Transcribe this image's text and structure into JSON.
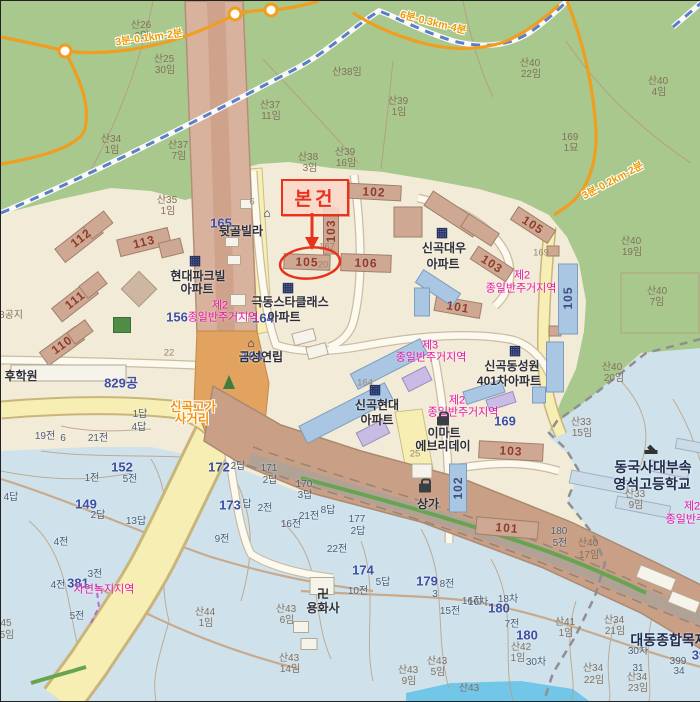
{
  "palette": {
    "urban": "#f2ebd8",
    "forest": "#a8c88e",
    "fields": "#cfe2ec",
    "water": "#72c6e8",
    "road_tan": "#d8b29c",
    "band": "#c99f86",
    "road_yellow": "#f7eeb4",
    "road_yellow_edge": "#c9b57c",
    "trail_orange": "#f09e20",
    "railway_blue": "#5b7ec8",
    "accent_red": "#e8321c",
    "zone_magenta": "#ea12a8",
    "parcel_blue": "#3d4fa4",
    "building_tan": "#cfa893",
    "building_blue": "#a9c6e2",
    "building_lav": "#c9bce4",
    "building_white": "#f6f3ea",
    "building_sky": "#ccdbe8"
  },
  "callout": {
    "label": "본건",
    "target_building": "105"
  },
  "map": {
    "labels": [
      {
        "t": "산26",
        "x": 140,
        "y": 25,
        "c": "mtn"
      },
      {
        "t": "3임",
        "x": 141,
        "y": 36,
        "c": "mtn"
      },
      {
        "t": "산25",
        "x": 163,
        "y": 59,
        "c": "mtn"
      },
      {
        "t": "30임",
        "x": 164,
        "y": 70,
        "c": "mtn"
      },
      {
        "t": "산34",
        "x": 110,
        "y": 139,
        "c": "mtn"
      },
      {
        "t": "1임",
        "x": 111,
        "y": 150,
        "c": "mtn"
      },
      {
        "t": "산37",
        "x": 269,
        "y": 105,
        "c": "mtn"
      },
      {
        "t": "11임",
        "x": 270,
        "y": 116,
        "c": "mtn"
      },
      {
        "t": "산37",
        "x": 177,
        "y": 145,
        "c": "mtn"
      },
      {
        "t": "7임",
        "x": 178,
        "y": 156,
        "c": "mtn"
      },
      {
        "t": "산38",
        "x": 307,
        "y": 157,
        "c": "mtn"
      },
      {
        "t": "3임",
        "x": 309,
        "y": 168,
        "c": "mtn"
      },
      {
        "t": "산39",
        "x": 344,
        "y": 152,
        "c": "mtn"
      },
      {
        "t": "16임",
        "x": 345,
        "y": 163,
        "c": "mtn"
      },
      {
        "t": "산38임",
        "x": 346,
        "y": 72,
        "c": "mtn"
      },
      {
        "t": "산39",
        "x": 397,
        "y": 101,
        "c": "mtn"
      },
      {
        "t": "1임",
        "x": 398,
        "y": 112,
        "c": "mtn"
      },
      {
        "t": "산40",
        "x": 529,
        "y": 63,
        "c": "mtn"
      },
      {
        "t": "22임",
        "x": 530,
        "y": 74,
        "c": "mtn"
      },
      {
        "t": "산40",
        "x": 657,
        "y": 81,
        "c": "mtn"
      },
      {
        "t": "4임",
        "x": 658,
        "y": 92,
        "c": "mtn"
      },
      {
        "t": "169",
        "x": 569,
        "y": 137,
        "c": "mtn"
      },
      {
        "t": "1묘",
        "x": 570,
        "y": 148,
        "c": "mtn"
      },
      {
        "t": "산35",
        "x": 166,
        "y": 200,
        "c": "mtn"
      },
      {
        "t": "1임",
        "x": 167,
        "y": 211,
        "c": "mtn"
      },
      {
        "t": "산40",
        "x": 630,
        "y": 241,
        "c": "mtn"
      },
      {
        "t": "19임",
        "x": 631,
        "y": 252,
        "c": "mtn"
      },
      {
        "t": "산40",
        "x": 656,
        "y": 291,
        "c": "mtn"
      },
      {
        "t": "7임",
        "x": 656,
        "y": 302,
        "c": "mtn"
      },
      {
        "t": "산40",
        "x": 611,
        "y": 367,
        "c": "mtn"
      },
      {
        "t": "20임",
        "x": 613,
        "y": 378,
        "c": "mtn"
      },
      {
        "t": "산33",
        "x": 580,
        "y": 422,
        "c": "mtn"
      },
      {
        "t": "15임",
        "x": 581,
        "y": 433,
        "c": "mtn"
      },
      {
        "t": "산33",
        "x": 634,
        "y": 494,
        "c": "mtn"
      },
      {
        "t": "9임",
        "x": 635,
        "y": 505,
        "c": "mtn"
      },
      {
        "t": "산44",
        "x": 204,
        "y": 612,
        "c": "mtn"
      },
      {
        "t": "1임",
        "x": 205,
        "y": 623,
        "c": "mtn"
      },
      {
        "t": "45",
        "x": 5,
        "y": 623,
        "c": "mtn"
      },
      {
        "t": "5임",
        "x": 6,
        "y": 635,
        "c": "mtn"
      },
      {
        "t": "산43",
        "x": 285,
        "y": 609,
        "c": "mtn"
      },
      {
        "t": "6임",
        "x": 286,
        "y": 620,
        "c": "mtn"
      },
      {
        "t": "산43",
        "x": 288,
        "y": 658,
        "c": "mtn"
      },
      {
        "t": "14임",
        "x": 289,
        "y": 669,
        "c": "mtn"
      },
      {
        "t": "산43",
        "x": 407,
        "y": 670,
        "c": "mtn"
      },
      {
        "t": "9임",
        "x": 408,
        "y": 681,
        "c": "mtn"
      },
      {
        "t": "산43",
        "x": 436,
        "y": 661,
        "c": "mtn"
      },
      {
        "t": "5임",
        "x": 437,
        "y": 672,
        "c": "mtn"
      },
      {
        "t": "산43",
        "x": 468,
        "y": 688,
        "c": "mtn"
      },
      {
        "t": "산41",
        "x": 564,
        "y": 622,
        "c": "mtn"
      },
      {
        "t": "1임",
        "x": 565,
        "y": 633,
        "c": "mtn"
      },
      {
        "t": "산34",
        "x": 613,
        "y": 620,
        "c": "mtn"
      },
      {
        "t": "21임",
        "x": 614,
        "y": 631,
        "c": "mtn"
      },
      {
        "t": "산34",
        "x": 592,
        "y": 668,
        "c": "mtn"
      },
      {
        "t": "22임",
        "x": 593,
        "y": 680,
        "c": "mtn"
      },
      {
        "t": "산34",
        "x": 636,
        "y": 677,
        "c": "mtn"
      },
      {
        "t": "23임",
        "x": 637,
        "y": 688,
        "c": "mtn"
      },
      {
        "t": "산40",
        "x": 587,
        "y": 543,
        "c": "mtn"
      },
      {
        "t": "17임",
        "x": 588,
        "y": 555,
        "c": "mtn"
      },
      {
        "t": "산42",
        "x": 520,
        "y": 647,
        "c": "mtn"
      },
      {
        "t": "1임",
        "x": 517,
        "y": 658,
        "c": "mtn"
      },
      {
        "t": "8공지",
        "x": 10,
        "y": 315,
        "c": "mtn"
      },
      {
        "t": "1전",
        "x": 91,
        "y": 478,
        "c": "fld"
      },
      {
        "t": "5전",
        "x": 129,
        "y": 479,
        "c": "fld"
      },
      {
        "t": "4답",
        "x": 10,
        "y": 497,
        "c": "fld"
      },
      {
        "t": "2답",
        "x": 97,
        "y": 515,
        "c": "fld"
      },
      {
        "t": "13답",
        "x": 135,
        "y": 521,
        "c": "fld"
      },
      {
        "t": "4전",
        "x": 60,
        "y": 542,
        "c": "fld"
      },
      {
        "t": "4전",
        "x": 57,
        "y": 585,
        "c": "fld"
      },
      {
        "t": "3전",
        "x": 94,
        "y": 574,
        "c": "fld"
      },
      {
        "t": "5전",
        "x": 76,
        "y": 616,
        "c": "fld"
      },
      {
        "t": "9전",
        "x": 221,
        "y": 539,
        "c": "fld"
      },
      {
        "t": "2전",
        "x": 264,
        "y": 508,
        "c": "fld"
      },
      {
        "t": "16전",
        "x": 290,
        "y": 524,
        "c": "fld"
      },
      {
        "t": "21전",
        "x": 308,
        "y": 516,
        "c": "fld"
      },
      {
        "t": "8답",
        "x": 327,
        "y": 510,
        "c": "fld"
      },
      {
        "t": "177",
        "x": 356,
        "y": 519,
        "c": "fld"
      },
      {
        "t": "2답",
        "x": 357,
        "y": 531,
        "c": "fld"
      },
      {
        "t": "22전",
        "x": 336,
        "y": 549,
        "c": "fld"
      },
      {
        "t": "5답",
        "x": 382,
        "y": 582,
        "c": "fld"
      },
      {
        "t": "10전",
        "x": 357,
        "y": 591,
        "c": "fld"
      },
      {
        "t": "8전",
        "x": 446,
        "y": 584,
        "c": "fld"
      },
      {
        "t": "3",
        "x": 434,
        "y": 594,
        "c": "fld"
      },
      {
        "t": "16전",
        "x": 471,
        "y": 601,
        "c": "fld"
      },
      {
        "t": "15전",
        "x": 449,
        "y": 611,
        "c": "fld"
      },
      {
        "t": "171",
        "x": 268,
        "y": 468,
        "c": "fld"
      },
      {
        "t": "2답",
        "x": 269,
        "y": 480,
        "c": "fld"
      },
      {
        "t": "170",
        "x": 303,
        "y": 484,
        "c": "fld"
      },
      {
        "t": "3답",
        "x": 304,
        "y": 495,
        "c": "fld"
      },
      {
        "t": "19전",
        "x": 44,
        "y": 436,
        "c": "fld"
      },
      {
        "t": "6",
        "x": 62,
        "y": 438,
        "c": "fld"
      },
      {
        "t": "21전",
        "x": 97,
        "y": 438,
        "c": "fld"
      },
      {
        "t": "1답",
        "x": 139,
        "y": 414,
        "c": "fld"
      },
      {
        "t": "4답",
        "x": 138,
        "y": 427,
        "c": "fld"
      },
      {
        "t": "2답",
        "x": 237,
        "y": 466,
        "c": "fld"
      },
      {
        "t": "답",
        "x": 246,
        "y": 504,
        "c": "fld"
      },
      {
        "t": "180",
        "x": 558,
        "y": 531,
        "c": "fld"
      },
      {
        "t": "5전",
        "x": 559,
        "y": 543,
        "c": "fld"
      },
      {
        "t": "7전",
        "x": 511,
        "y": 624,
        "c": "fld"
      },
      {
        "t": "16차",
        "x": 477,
        "y": 602,
        "c": "fld"
      },
      {
        "t": "18차",
        "x": 507,
        "y": 599,
        "c": "fld"
      },
      {
        "t": "30차",
        "x": 535,
        "y": 662,
        "c": "fld"
      },
      {
        "t": "30차",
        "x": 637,
        "y": 651,
        "c": "fld"
      },
      {
        "t": "31",
        "x": 637,
        "y": 668,
        "c": "fld"
      },
      {
        "t": "399",
        "x": 677,
        "y": 661,
        "c": "fld"
      },
      {
        "t": "34",
        "x": 678,
        "y": 671,
        "c": "fld"
      },
      {
        "t": "22",
        "x": 168,
        "y": 352,
        "c": "g"
      },
      {
        "t": "6",
        "x": 251,
        "y": 201,
        "c": "g"
      },
      {
        "t": "167",
        "x": 326,
        "y": 246,
        "c": "g"
      },
      {
        "t": "20",
        "x": 322,
        "y": 264,
        "c": "g"
      },
      {
        "t": "169",
        "x": 540,
        "y": 252,
        "c": "g"
      },
      {
        "t": "25",
        "x": 414,
        "y": 453,
        "c": "g"
      },
      {
        "t": "164",
        "x": 364,
        "y": 382,
        "c": "g"
      },
      {
        "t": "156",
        "x": 176,
        "y": 316,
        "c": "num"
      },
      {
        "t": "164",
        "x": 262,
        "y": 317,
        "c": "num"
      },
      {
        "t": "165",
        "x": 220,
        "y": 222,
        "c": "num"
      },
      {
        "t": "164",
        "x": 251,
        "y": 355,
        "c": "num"
      },
      {
        "t": "152",
        "x": 121,
        "y": 466,
        "c": "num"
      },
      {
        "t": "149",
        "x": 85,
        "y": 503,
        "c": "num"
      },
      {
        "t": "381",
        "x": 77,
        "y": 582,
        "c": "num"
      },
      {
        "t": "174",
        "x": 362,
        "y": 569,
        "c": "num"
      },
      {
        "t": "179",
        "x": 426,
        "y": 580,
        "c": "num"
      },
      {
        "t": "172",
        "x": 218,
        "y": 466,
        "c": "num"
      },
      {
        "t": "173",
        "x": 229,
        "y": 504,
        "c": "num"
      },
      {
        "t": "180",
        "x": 498,
        "y": 607,
        "c": "num"
      },
      {
        "t": "180",
        "x": 526,
        "y": 634,
        "c": "num"
      },
      {
        "t": "169",
        "x": 504,
        "y": 420,
        "c": "num"
      },
      {
        "t": "829공",
        "x": 120,
        "y": 382,
        "c": "num"
      },
      {
        "t": "39",
        "x": 698,
        "y": 654,
        "c": "num"
      },
      {
        "t": "현대파크빌",
        "x": 197,
        "y": 275,
        "c": "apt"
      },
      {
        "t": "아파트",
        "x": 196,
        "y": 288,
        "c": "apt"
      },
      {
        "t": "뒷골빌라",
        "x": 240,
        "y": 230,
        "c": "apt"
      },
      {
        "t": "극동스타클래스",
        "x": 289,
        "y": 301,
        "c": "apt"
      },
      {
        "t": "아파트",
        "x": 283,
        "y": 316,
        "c": "apt"
      },
      {
        "t": "신곡대우",
        "x": 443,
        "y": 247,
        "c": "apt"
      },
      {
        "t": "아파트",
        "x": 442,
        "y": 263,
        "c": "apt"
      },
      {
        "t": "신곡현대",
        "x": 376,
        "y": 404,
        "c": "apt"
      },
      {
        "t": "아파트",
        "x": 376,
        "y": 419,
        "c": "apt"
      },
      {
        "t": "신곡동성원",
        "x": 511,
        "y": 365,
        "c": "apt"
      },
      {
        "t": "401차아파트",
        "x": 508,
        "y": 380,
        "c": "apt"
      },
      {
        "t": "금성연립",
        "x": 260,
        "y": 356,
        "c": "apt"
      },
      {
        "t": "이마트",
        "x": 443,
        "y": 432,
        "c": "apt"
      },
      {
        "t": "에브리데이",
        "x": 442,
        "y": 445,
        "c": "apt"
      },
      {
        "t": "상가",
        "x": 427,
        "y": 503,
        "c": "apt"
      },
      {
        "t": "용화사",
        "x": 322,
        "y": 607,
        "c": "apt"
      },
      {
        "t": "후학원",
        "x": 20,
        "y": 375,
        "c": "apt"
      },
      {
        "t": "대동종합목재",
        "x": 668,
        "y": 639,
        "c": "big"
      },
      {
        "t": "동국사대부속",
        "x": 652,
        "y": 466,
        "c": "big"
      },
      {
        "t": "영석고등학교",
        "x": 651,
        "y": 483,
        "c": "big"
      },
      {
        "t": "제2",
        "x": 219,
        "y": 305,
        "c": "zone"
      },
      {
        "t": "종일반주거지역",
        "x": 222,
        "y": 317,
        "c": "zone"
      },
      {
        "t": "제2",
        "x": 521,
        "y": 275,
        "c": "zone"
      },
      {
        "t": "종일반주거지역",
        "x": 520,
        "y": 288,
        "c": "zone"
      },
      {
        "t": "제3",
        "x": 429,
        "y": 345,
        "c": "zone"
      },
      {
        "t": "종일반주거지역",
        "x": 430,
        "y": 357,
        "c": "zone"
      },
      {
        "t": "제2",
        "x": 456,
        "y": 400,
        "c": "zone"
      },
      {
        "t": "종일반주거지역",
        "x": 462,
        "y": 412,
        "c": "zone"
      },
      {
        "t": "자연녹지지역",
        "x": 103,
        "y": 589,
        "c": "zone"
      },
      {
        "t": "제2",
        "x": 691,
        "y": 506,
        "c": "zone"
      },
      {
        "t": "종일반주거지역",
        "x": 700,
        "y": 519,
        "c": "zone"
      },
      {
        "t": "신곡고가",
        "x": 192,
        "y": 406,
        "c": "road"
      },
      {
        "t": "사거리",
        "x": 191,
        "y": 418,
        "c": "road"
      },
      {
        "t": "3분-0.1km-2분",
        "x": 148,
        "y": 37,
        "c": "trail",
        "r": -8
      },
      {
        "t": "6분-0.3km-4분",
        "x": 432,
        "y": 22,
        "c": "trail",
        "r": 14
      },
      {
        "t": "3분-0.2km-2분",
        "x": 612,
        "y": 180,
        "c": "trail",
        "r": -28
      },
      {
        "t": "112",
        "x": 80,
        "y": 237,
        "c": "bnum",
        "r": -38
      },
      {
        "t": "113",
        "x": 143,
        "y": 241,
        "c": "bnum",
        "r": -14
      },
      {
        "t": "111",
        "x": 74,
        "y": 299,
        "c": "bnum",
        "r": -38
      },
      {
        "t": "110",
        "x": 61,
        "y": 344,
        "c": "bnum",
        "r": -36
      },
      {
        "t": "102",
        "x": 373,
        "y": 191,
        "c": "bnum",
        "r": 3
      },
      {
        "t": "103",
        "x": 330,
        "y": 230,
        "c": "bnum",
        "r": -90
      },
      {
        "t": "105",
        "x": 306,
        "y": 261,
        "c": "bnum",
        "r": 2
      },
      {
        "t": "106",
        "x": 365,
        "y": 262,
        "c": "bnum",
        "r": 2
      },
      {
        "t": "105",
        "x": 532,
        "y": 224,
        "c": "bnum",
        "r": 33
      },
      {
        "t": "103",
        "x": 491,
        "y": 263,
        "c": "bnum",
        "r": 33
      },
      {
        "t": "101",
        "x": 457,
        "y": 306,
        "c": "bnum",
        "r": 10
      },
      {
        "t": "105",
        "x": 567,
        "y": 297,
        "c": "bnumb",
        "r": -90
      },
      {
        "t": "102",
        "x": 457,
        "y": 487,
        "c": "bnumb",
        "r": -90
      },
      {
        "t": "103",
        "x": 510,
        "y": 450,
        "c": "bnum",
        "r": 3
      },
      {
        "t": "101",
        "x": 506,
        "y": 527,
        "c": "bnum",
        "r": 5
      }
    ],
    "icons": [
      {
        "type": "apartment-icon",
        "x": 194,
        "y": 259
      },
      {
        "type": "apartment-icon",
        "x": 287,
        "y": 286
      },
      {
        "type": "apartment-icon",
        "x": 441,
        "y": 231
      },
      {
        "type": "apartment-icon",
        "x": 374,
        "y": 388
      },
      {
        "type": "apartment-icon",
        "x": 514,
        "y": 349
      },
      {
        "type": "house-icon",
        "x": 266,
        "y": 212
      },
      {
        "type": "house-icon",
        "x": 250,
        "y": 342
      },
      {
        "type": "bag-icon",
        "x": 442,
        "y": 420
      },
      {
        "type": "bag-icon",
        "x": 424,
        "y": 487
      },
      {
        "type": "school-icon",
        "x": 650,
        "y": 451
      },
      {
        "type": "temple-icon",
        "x": 322,
        "y": 593
      }
    ]
  }
}
